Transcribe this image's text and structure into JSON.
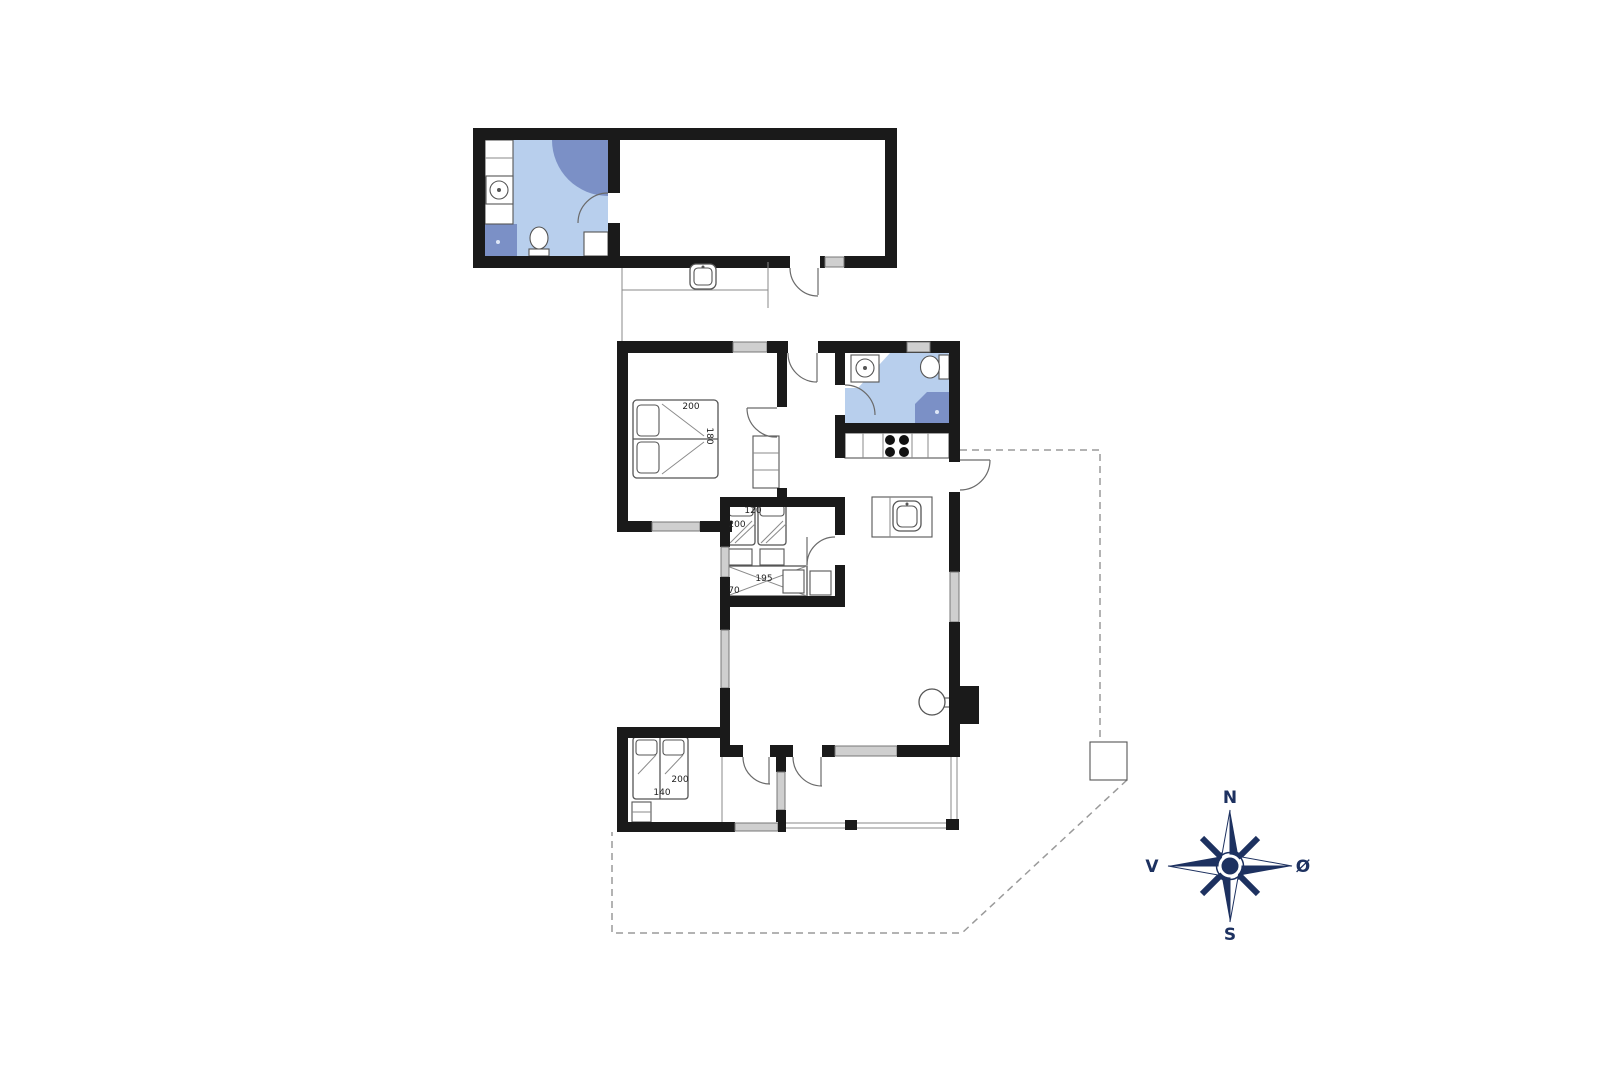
{
  "floor_plan": {
    "bedroom_1": {
      "width_label": "200",
      "depth_label": "180"
    },
    "bedroom_2": {
      "bed_width_label": "120",
      "bed_length_label": "200",
      "bunk_length_label": "195",
      "bunk_width_label": "70"
    },
    "bedroom_3": {
      "bed_length_label": "200",
      "bed_width_label": "140"
    }
  },
  "compass": {
    "north": "N",
    "south": "S",
    "west": "V",
    "east": "Ø"
  },
  "colors": {
    "wall": "#1a1a1a",
    "bathroom_floor": "#b8cfed",
    "wet_zone": "#7b90c6",
    "window": "#cfcfcf",
    "outline": "#555555",
    "dashed_boundary": "#9a9a9a",
    "compass_navy": "#1d3160"
  }
}
